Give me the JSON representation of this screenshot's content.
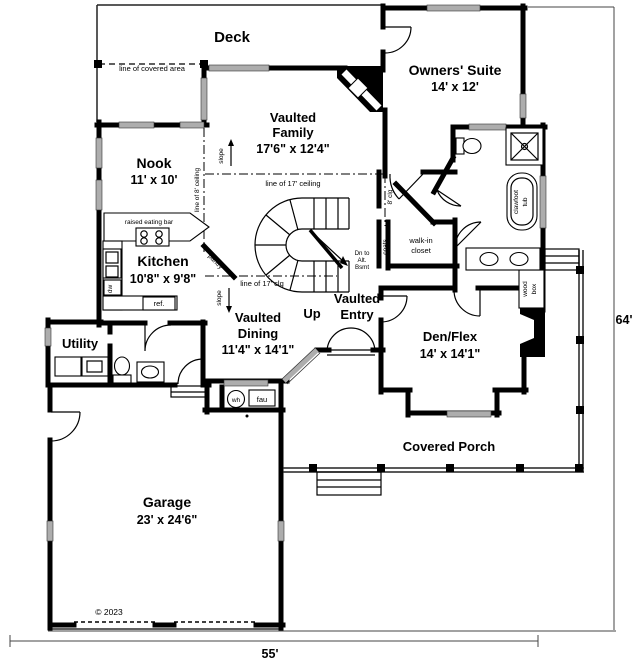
{
  "plan": {
    "deck": {
      "label": "Deck",
      "covered_area": "line of covered area"
    },
    "rooms": {
      "owners_suite": {
        "name": "Owners' Suite",
        "dims": "14' x 12'"
      },
      "family": {
        "name1": "Vaulted",
        "name2": "Family",
        "dims": "17'6\" x 12'4\""
      },
      "nook": {
        "name": "Nook",
        "dims": "11' x 10'"
      },
      "kitchen": {
        "name": "Kitchen",
        "dims": "10'8\" x 9'8\""
      },
      "dining": {
        "name1": "Vaulted",
        "name2": "Dining",
        "dims": "11'4\" x 14'1\""
      },
      "entry": {
        "name1": "Vaulted",
        "name2": "Entry"
      },
      "den": {
        "name": "Den/Flex",
        "dims": "14' x 14'1\""
      },
      "utility": {
        "name": "Utility"
      },
      "garage": {
        "name": "Garage",
        "dims": "23' x 24'6\""
      },
      "porch": {
        "name": "Covered Porch"
      },
      "walk_in": {
        "name1": "walk-in",
        "name2": "closet"
      }
    },
    "annotations": {
      "up": "Up",
      "dn_line1": "Dn to",
      "dn_line2": "Alt.",
      "dn_line3": "Bsmt",
      "coats": "coats",
      "clg_8": "8' clg",
      "line_17_ceiling": "line of 17' ceiling",
      "line_17_clg": "line of 17' clg",
      "line_8_ceiling": "line of 8' ceiling",
      "slope": "slope",
      "pantry": "pantry"
    },
    "fixtures": {
      "wh": "wh",
      "fau": "fau",
      "ref": "ref.",
      "dw": "dw",
      "clawfoot1": "clawfoot",
      "clawfoot2": "tub",
      "wood1": "wood",
      "wood2": "box",
      "eating_bar": "raised eating bar"
    },
    "dimensions": {
      "width": "55'",
      "height": "64'"
    },
    "copyright": "© 2023"
  }
}
